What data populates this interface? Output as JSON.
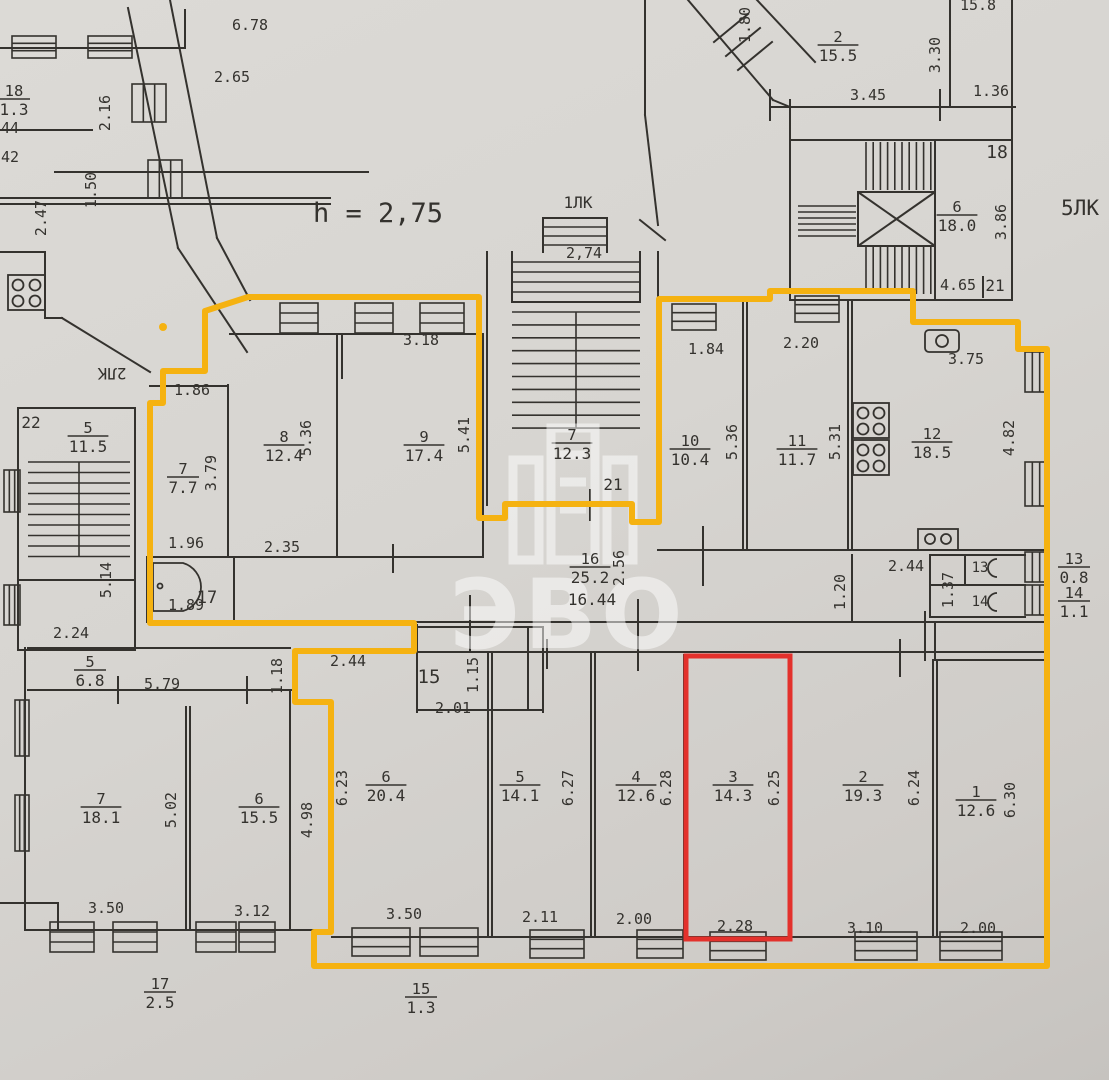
{
  "meta": {
    "kind": "scanned apartment floor plan with highlighted units",
    "ceiling_note": "h = 2,75"
  },
  "colors": {
    "paper": "#d7d5d1",
    "ink": "#34322e",
    "highlight_yellow": "#F5B211",
    "highlight_red": "#E3312C",
    "watermark": "#ffffff"
  },
  "watermark": {
    "text": "ЭВО"
  },
  "room_labels": [
    {
      "n": "18",
      "a": "1.3",
      "x": 14,
      "y": 99
    },
    {
      "n": "2",
      "a": "15.5",
      "x": 838,
      "y": 45
    },
    {
      "n": "6",
      "a": "18.0",
      "x": 957,
      "y": 215
    },
    {
      "n": "5",
      "a": "11.5",
      "x": 88,
      "y": 436
    },
    {
      "n": "7",
      "a": "7.7",
      "x": 183,
      "y": 477
    },
    {
      "n": "8",
      "a": "12.4",
      "x": 284,
      "y": 445
    },
    {
      "n": "9",
      "a": "17.4",
      "x": 424,
      "y": 445
    },
    {
      "n": "7",
      "a": "12.3",
      "x": 572,
      "y": 443
    },
    {
      "n": "10",
      "a": "10.4",
      "x": 690,
      "y": 449
    },
    {
      "n": "11",
      "a": "11.7",
      "x": 797,
      "y": 449
    },
    {
      "n": "12",
      "a": "18.5",
      "x": 932,
      "y": 442
    },
    {
      "n": "16",
      "a": "25.2",
      "x": 590,
      "y": 567
    },
    {
      "n": "13",
      "a": "0.8",
      "x": 1074,
      "y": 567
    },
    {
      "n": "14",
      "a": "1.1",
      "x": 1074,
      "y": 601
    },
    {
      "n": "5",
      "a": "6.8",
      "x": 90,
      "y": 670
    },
    {
      "n": "7",
      "a": "18.1",
      "x": 101,
      "y": 807
    },
    {
      "n": "6",
      "a": "15.5",
      "x": 259,
      "y": 807
    },
    {
      "n": "6",
      "a": "20.4",
      "x": 386,
      "y": 785
    },
    {
      "n": "5",
      "a": "14.1",
      "x": 520,
      "y": 785
    },
    {
      "n": "4",
      "a": "12.6",
      "x": 636,
      "y": 785
    },
    {
      "n": "3",
      "a": "14.3",
      "x": 733,
      "y": 785
    },
    {
      "n": "2",
      "a": "19.3",
      "x": 863,
      "y": 785
    },
    {
      "n": "1",
      "a": "12.6",
      "x": 976,
      "y": 800
    },
    {
      "n": "17",
      "a": "2.5",
      "x": 160,
      "y": 992
    },
    {
      "n": "15",
      "a": "1.3",
      "x": 421,
      "y": 997
    }
  ],
  "dim_labels": [
    {
      "t": "6.78",
      "x": 250,
      "y": 30
    },
    {
      "t": "2.65",
      "x": 232,
      "y": 82
    },
    {
      "t": "2.16",
      "x": 110,
      "y": 113,
      "r": -90
    },
    {
      "t": "1.50",
      "x": 96,
      "y": 190,
      "r": -90
    },
    {
      "t": "2.47",
      "x": 46,
      "y": 218,
      "r": -90
    },
    {
      "t": "44",
      "x": 10,
      "y": 133
    },
    {
      "t": "42",
      "x": 10,
      "y": 162
    },
    {
      "t": "1.80",
      "x": 750,
      "y": 25,
      "r": -90
    },
    {
      "t": "15.8",
      "x": 978,
      "y": 10
    },
    {
      "t": "3.30",
      "x": 940,
      "y": 55,
      "r": -90
    },
    {
      "t": "3.45",
      "x": 868,
      "y": 100
    },
    {
      "t": "1.36",
      "x": 991,
      "y": 96
    },
    {
      "t": "18",
      "x": 997,
      "y": 158,
      "s": 18
    },
    {
      "t": "1ЛК",
      "x": 578,
      "y": 208,
      "s": 16
    },
    {
      "t": "2,74",
      "x": 584,
      "y": 258
    },
    {
      "t": "h = 2,75",
      "x": 378,
      "y": 222,
      "s": 27
    },
    {
      "t": "5ЛК",
      "x": 1080,
      "y": 215,
      "s": 21
    },
    {
      "t": "3.86",
      "x": 1006,
      "y": 222,
      "r": -90
    },
    {
      "t": "4.65",
      "x": 958,
      "y": 290
    },
    {
      "t": "21",
      "x": 995,
      "y": 291,
      "s": 16
    },
    {
      "t": "3.18",
      "x": 421,
      "y": 345
    },
    {
      "t": "1.84",
      "x": 706,
      "y": 354
    },
    {
      "t": "2.20",
      "x": 801,
      "y": 348
    },
    {
      "t": "3.75",
      "x": 966,
      "y": 364
    },
    {
      "t": "1.86",
      "x": 192,
      "y": 395
    },
    {
      "t": "2ЛК",
      "x": 112,
      "y": 368,
      "r": 180,
      "s": 16
    },
    {
      "t": "22",
      "x": 31,
      "y": 428,
      "s": 16
    },
    {
      "t": "3.79",
      "x": 216,
      "y": 473,
      "r": -90
    },
    {
      "t": "5.36",
      "x": 311,
      "y": 438,
      "r": -90
    },
    {
      "t": "5.41",
      "x": 469,
      "y": 435,
      "r": -90
    },
    {
      "t": "5.36",
      "x": 737,
      "y": 442,
      "r": -90
    },
    {
      "t": "5.31",
      "x": 840,
      "y": 442,
      "r": -90
    },
    {
      "t": "4.82",
      "x": 1014,
      "y": 438,
      "r": -90
    },
    {
      "t": "21",
      "x": 613,
      "y": 490,
      "s": 16
    },
    {
      "t": "2.56",
      "x": 624,
      "y": 568,
      "r": -90
    },
    {
      "t": "1.96",
      "x": 186,
      "y": 548
    },
    {
      "t": "2.35",
      "x": 282,
      "y": 552
    },
    {
      "t": "17",
      "x": 207,
      "y": 603,
      "s": 17
    },
    {
      "t": "1.89",
      "x": 186,
      "y": 610
    },
    {
      "t": "2.24",
      "x": 71,
      "y": 638
    },
    {
      "t": "5.14",
      "x": 111,
      "y": 580,
      "r": -90
    },
    {
      "t": "2.44",
      "x": 906,
      "y": 571
    },
    {
      "t": "1.20",
      "x": 845,
      "y": 592,
      "r": -90
    },
    {
      "t": "1.37",
      "x": 953,
      "y": 590,
      "r": -90
    },
    {
      "t": "13",
      "x": 980,
      "y": 572,
      "s": 14
    },
    {
      "t": "14",
      "x": 980,
      "y": 606,
      "s": 14
    },
    {
      "t": "16.44",
      "x": 592,
      "y": 605,
      "s": 16
    },
    {
      "t": "2.44",
      "x": 348,
      "y": 666
    },
    {
      "t": "1.18",
      "x": 282,
      "y": 676,
      "r": -90
    },
    {
      "t": "15",
      "x": 429,
      "y": 683,
      "s": 19
    },
    {
      "t": "1.15",
      "x": 478,
      "y": 675,
      "r": -90
    },
    {
      "t": "2.01",
      "x": 453,
      "y": 713
    },
    {
      "t": "5.79",
      "x": 162,
      "y": 689
    },
    {
      "t": "5.02",
      "x": 176,
      "y": 810,
      "r": -90
    },
    {
      "t": "4.98",
      "x": 312,
      "y": 820,
      "r": -90
    },
    {
      "t": "6.23",
      "x": 347,
      "y": 788,
      "r": -90
    },
    {
      "t": "6.27",
      "x": 573,
      "y": 788,
      "r": -90
    },
    {
      "t": "6.28",
      "x": 671,
      "y": 788,
      "r": -90
    },
    {
      "t": "6.25",
      "x": 779,
      "y": 788,
      "r": -90
    },
    {
      "t": "6.24",
      "x": 919,
      "y": 788,
      "r": -90
    },
    {
      "t": "6.30",
      "x": 1015,
      "y": 800,
      "r": -90
    },
    {
      "t": "3.50",
      "x": 106,
      "y": 913
    },
    {
      "t": "3.12",
      "x": 252,
      "y": 916
    },
    {
      "t": "3.50",
      "x": 404,
      "y": 919
    },
    {
      "t": "2.11",
      "x": 540,
      "y": 922
    },
    {
      "t": "2.00",
      "x": 634,
      "y": 924
    },
    {
      "t": "2.28",
      "x": 735,
      "y": 931
    },
    {
      "t": "3.10",
      "x": 865,
      "y": 933
    },
    {
      "t": "2.00",
      "x": 978,
      "y": 933
    }
  ]
}
